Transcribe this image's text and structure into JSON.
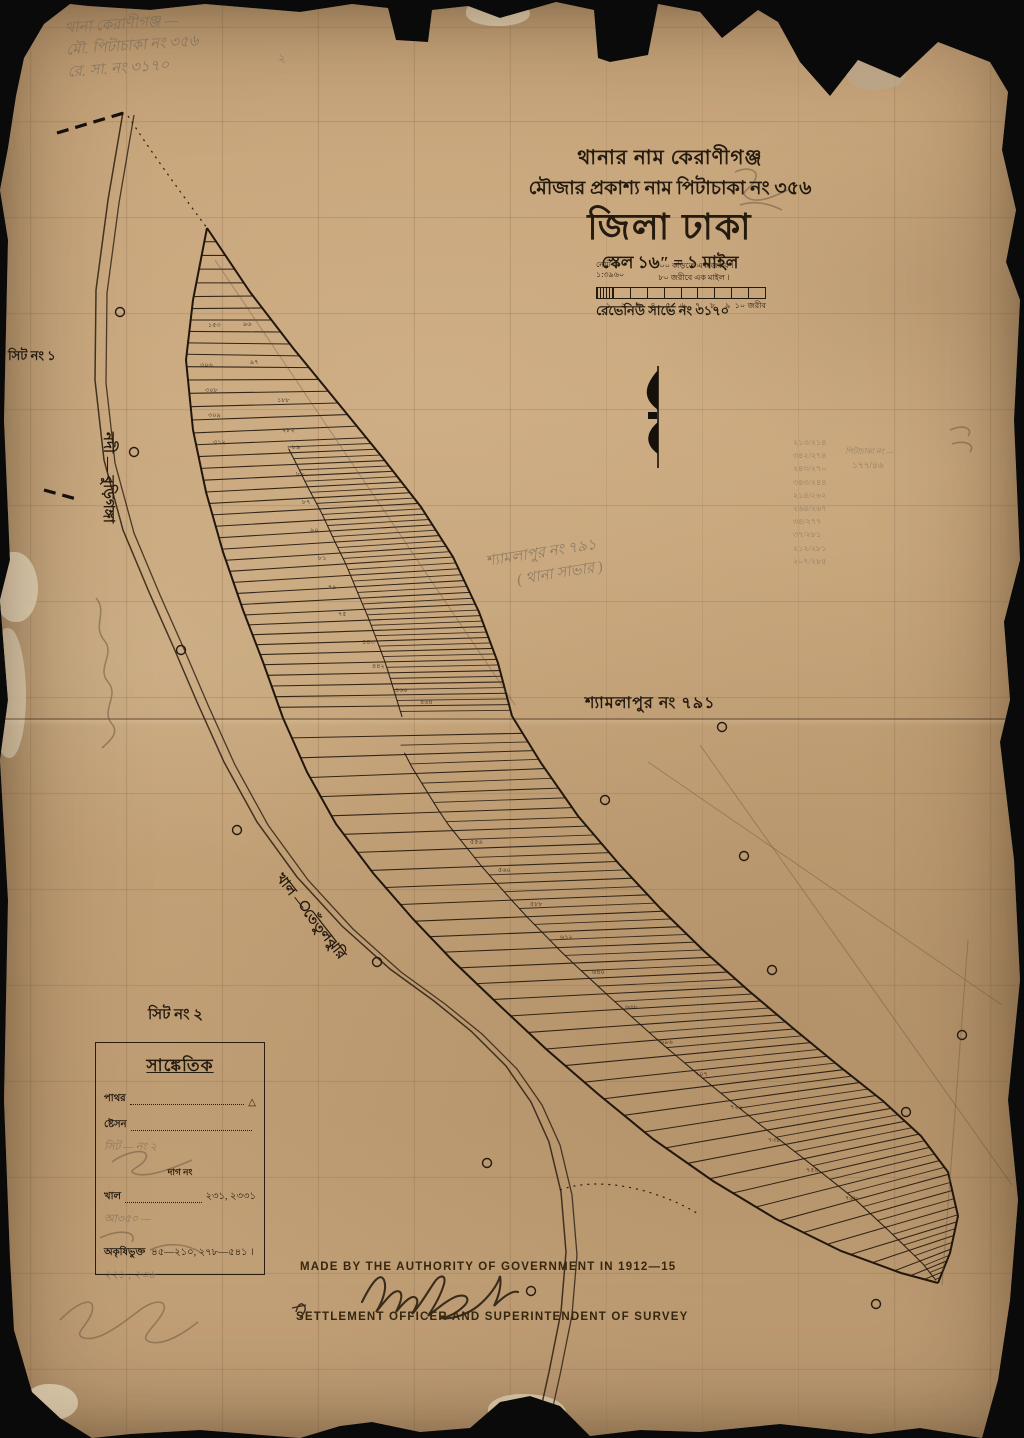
{
  "title_block": {
    "line1": "থানার নাম  কেরাণীগঞ্জ",
    "line2": "মৌজার প্রকাশ্য নাম   পিটাচাকা নং ৩৫৬",
    "line3": "জিলা ঢাকা",
    "line4": "স্কেল ১৬″ = ১ মাইল"
  },
  "scale_bar": {
    "rf_top": "নোট",
    "rf_bottom": "১:৩৯৬০",
    "note1": "১০০ কড়িতে এক জরীব ।",
    "note2": "৮০ জরীবে এক মাইল ।",
    "ticks": [
      "১",
      "২",
      "৩",
      "৪",
      "৫",
      "৬",
      "৭",
      "৮",
      "৯",
      "১০"
    ],
    "unit": "জরীব"
  },
  "revenue_survey": "রেভেনিউ সার্ভে নং ৩১৭০",
  "labels": {
    "sheet1": "সিট নং ১",
    "sheet2": "সিট নং ২",
    "neighbor": "শ্যামলাপুর নং ৭৯১",
    "river_upper": "নদী — বুড়িগঙ্গা",
    "river_lower": "খাল — তেঁতুলঝুরি"
  },
  "pencil_annotations": {
    "topleft_line1": "থানা কেরাণীগঞ্জ —",
    "topleft_line2": "মৌ. পিটাচাকা নং ৩৫৬",
    "topleft_line3": "রে. সা. নং ৩১৭০",
    "stray": "২",
    "center_line1": "শ্যামলাপুর নং ৭৯১",
    "center_line2": "( থানা সাভার )",
    "fraction_header": "পিটাচাকা নং —",
    "fraction_side": "১৭৭/৪৬",
    "fraction_column": [
      "২১৩/২১৪",
      "৩৪২/২৭৪",
      "২৪৩/২৭০",
      "৩৪৩/২৪৪",
      "২১৪/২৬২",
      "২৬৪/২৬৭",
      "৩৪/২৭৭",
      "৩৭/২৮১",
      "২১২/২৮১",
      "২০৭/২৮৫"
    ]
  },
  "legend": {
    "header": "সাঙ্কেতিক",
    "row_stone_label": "পাথর",
    "row_stone_symbol": "△",
    "row_station_label": "ষ্টেসন",
    "pencil_sheet": "সিট — নং ২",
    "dag_no": "দাগ নং",
    "row_khal_label": "খাল",
    "row_khal_value": "২৩১, ২৩৩১",
    "pencil_a": "আ৩৫০ —",
    "row_nonagri_label": "অকৃষিভুক্ত",
    "row_nonagri_value": "৪৫—২১০, ২৭৮—৫৪১ ।",
    "pencil_nums": "২২১ , ২৩৬"
  },
  "footer": {
    "made_by": "MADE BY THE AUTHORITY OF GOVERNMENT IN 1912—15",
    "officer": "SETTLEMENT OFFICER AND SUPERINTENDENT OF SURVEY"
  },
  "map": {
    "plot_numbers": [
      {
        "n": "১৫৩",
        "x": 208,
        "y": 320
      },
      {
        "n": "৯৬",
        "x": 243,
        "y": 319
      },
      {
        "n": "৩০৬",
        "x": 200,
        "y": 360
      },
      {
        "n": "৯৭",
        "x": 250,
        "y": 357
      },
      {
        "n": "৩০৮",
        "x": 205,
        "y": 385
      },
      {
        "n": "১৮৮",
        "x": 277,
        "y": 395
      },
      {
        "n": "৩০৯",
        "x": 208,
        "y": 410
      },
      {
        "n": "২৮২",
        "x": 282,
        "y": 425
      },
      {
        "n": "৩১২",
        "x": 213,
        "y": 437
      },
      {
        "n": "৮৯",
        "x": 292,
        "y": 442
      },
      {
        "n": "৮৮",
        "x": 296,
        "y": 469
      },
      {
        "n": "৮৭",
        "x": 302,
        "y": 497
      },
      {
        "n": "৯০",
        "x": 310,
        "y": 525
      },
      {
        "n": "৮১",
        "x": 318,
        "y": 553
      },
      {
        "n": "৭৯",
        "x": 328,
        "y": 582
      },
      {
        "n": "৭৫",
        "x": 338,
        "y": 609
      },
      {
        "n": "৪৪৩",
        "x": 362,
        "y": 637
      },
      {
        "n": "৪৪২",
        "x": 372,
        "y": 661
      },
      {
        "n": "৪৬০",
        "x": 395,
        "y": 685
      },
      {
        "n": "৪৬৪",
        "x": 420,
        "y": 697
      },
      {
        "n": "৫৫৬",
        "x": 470,
        "y": 837
      },
      {
        "n": "৫৬০",
        "x": 498,
        "y": 865
      },
      {
        "n": "৫৮৮",
        "x": 530,
        "y": 899
      },
      {
        "n": "৬১২",
        "x": 560,
        "y": 932
      },
      {
        "n": "৬৪০",
        "x": 592,
        "y": 967
      },
      {
        "n": "৬৬৮",
        "x": 625,
        "y": 1002
      },
      {
        "n": "৬৯৬",
        "x": 660,
        "y": 1037
      },
      {
        "n": "৭০৭",
        "x": 695,
        "y": 1069
      },
      {
        "n": "৭২২",
        "x": 730,
        "y": 1102
      },
      {
        "n": "৭৩৮",
        "x": 768,
        "y": 1135
      },
      {
        "n": "৭৫৪",
        "x": 806,
        "y": 1165
      },
      {
        "n": "৭৬৮",
        "x": 845,
        "y": 1193
      }
    ]
  }
}
